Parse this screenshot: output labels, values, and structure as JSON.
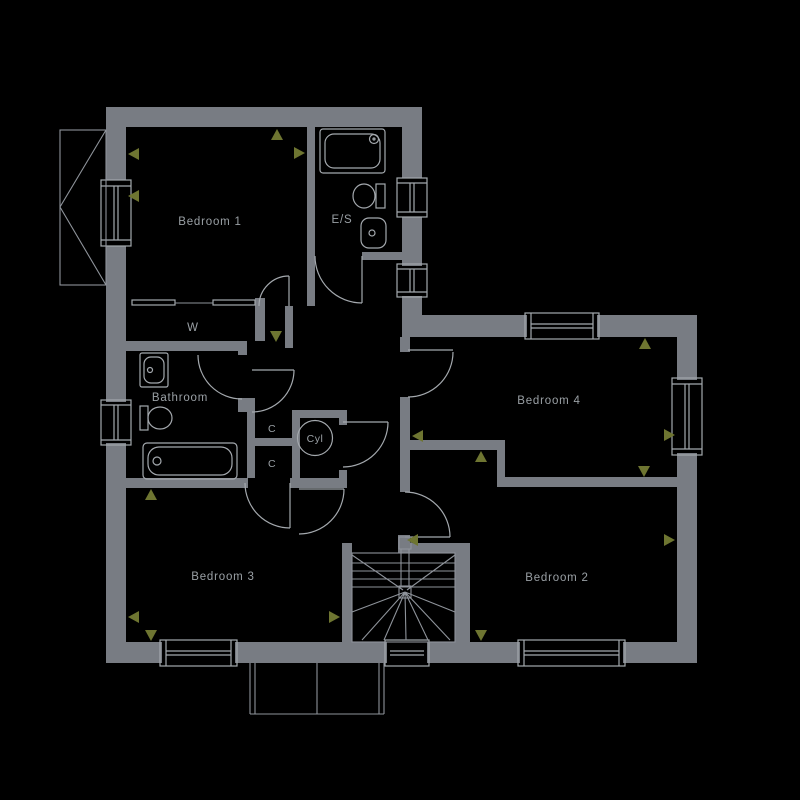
{
  "colors": {
    "background": "#000000",
    "wall": "#787c83",
    "line": "#a4a9ae",
    "line_dim": "#8e939a",
    "arrow": "#6e7531",
    "label": "#9aa0a5"
  },
  "rooms": {
    "bedroom1": {
      "label": "Bedroom 1"
    },
    "ensuite": {
      "label": "E/S"
    },
    "wardrobe": {
      "label": "W"
    },
    "bathroom": {
      "label": "Bathroom"
    },
    "cupboard_top": {
      "label": "C"
    },
    "cupboard_bottom": {
      "label": "C"
    },
    "cylinder": {
      "label": "Cyl"
    },
    "bedroom4": {
      "label": "Bedroom 4"
    },
    "bedroom3": {
      "label": "Bedroom 3"
    },
    "bedroom2": {
      "label": "Bedroom 2"
    }
  }
}
